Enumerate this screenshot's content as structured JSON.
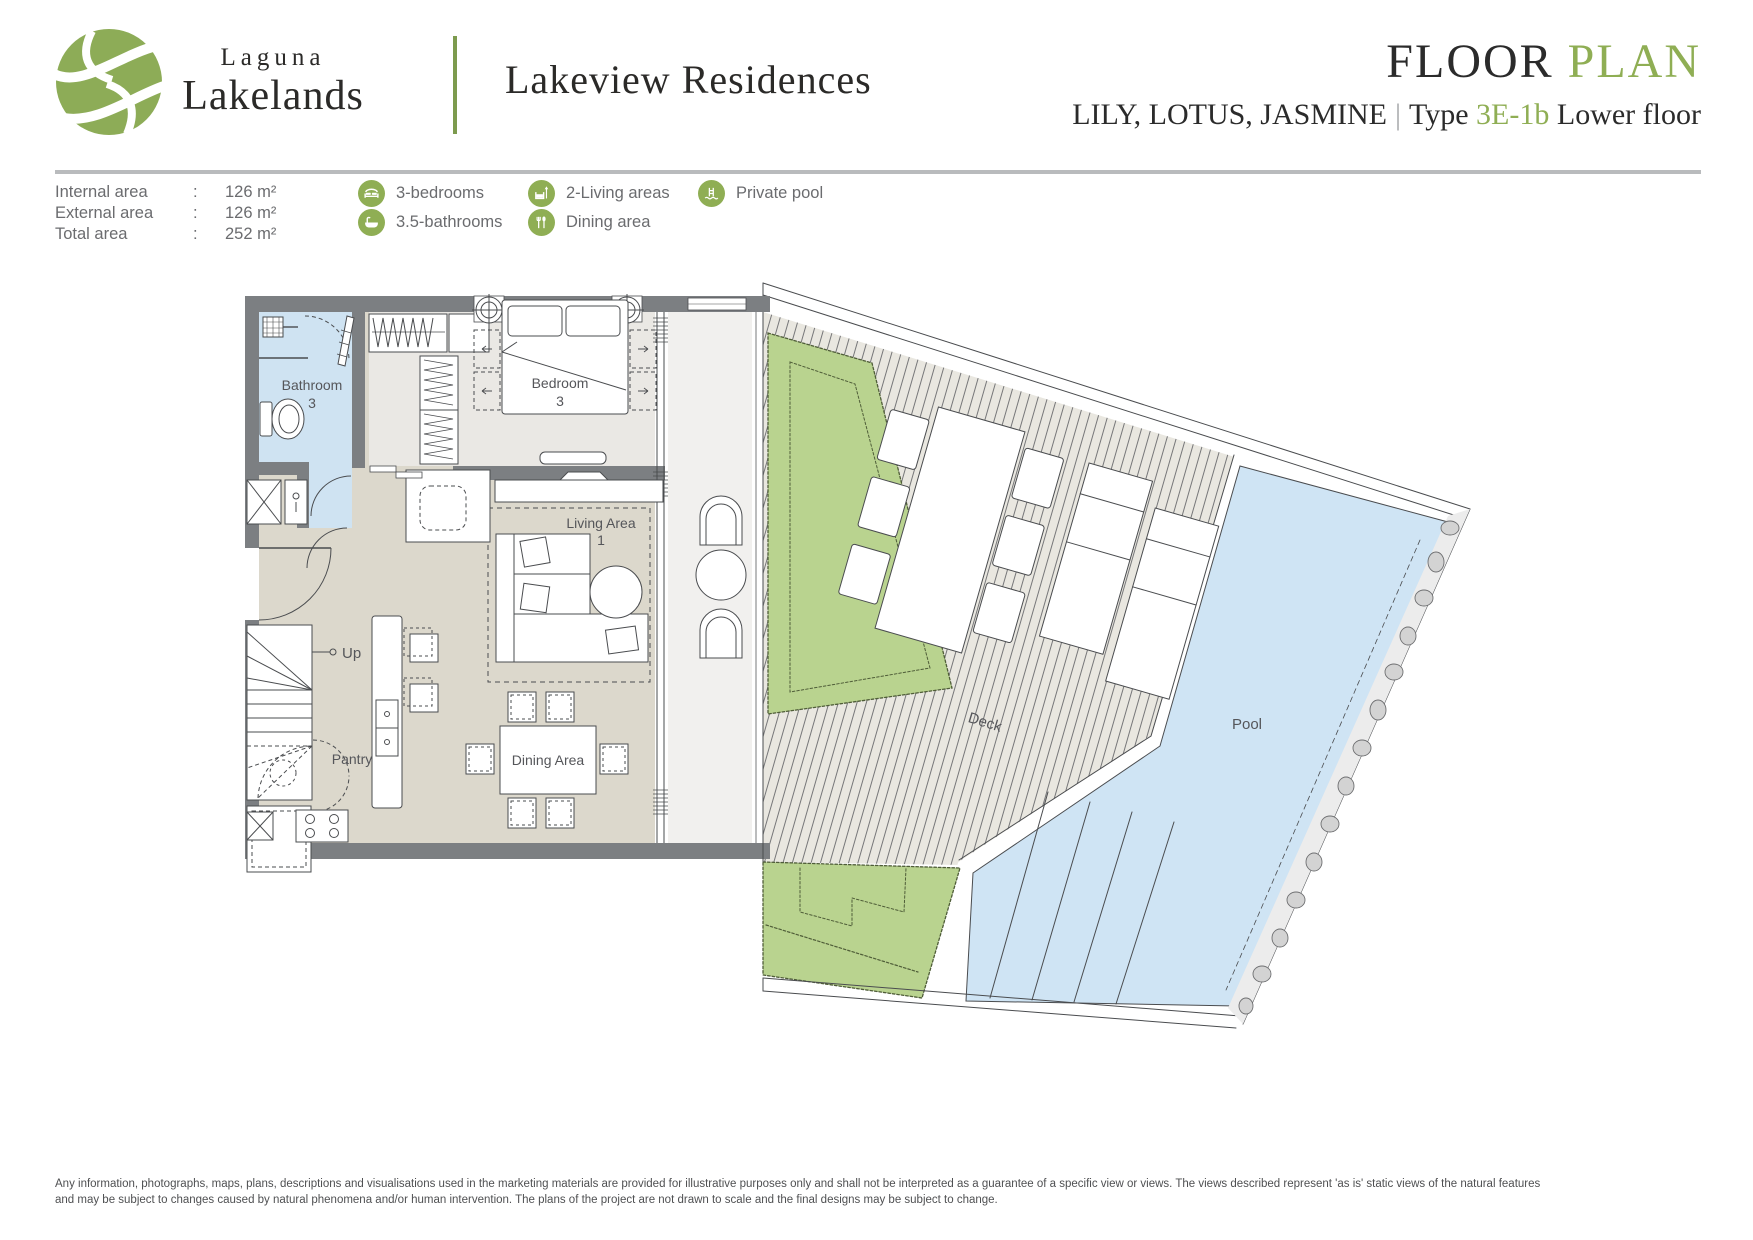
{
  "brand": {
    "name_top": "Laguna",
    "name_bottom": "Lakelands"
  },
  "header": {
    "project": "Lakeview Residences",
    "title_dark": "FLOOR",
    "title_green": "PLAN",
    "subtitle_names": "LILY, LOTUS, JASMINE",
    "subtitle_divider": "|",
    "subtitle_type_label": "Type",
    "subtitle_type_value": "3E-1b",
    "subtitle_floor": "Lower floor"
  },
  "areas": {
    "rows": [
      {
        "label": "Internal area",
        "colon": ":",
        "value": "126 m²"
      },
      {
        "label": "External area",
        "colon": ":",
        "value": "126 m²"
      },
      {
        "label": "Total area",
        "colon": ":",
        "value": "252 m²"
      }
    ]
  },
  "features": [
    {
      "icon": "bed-icon",
      "label": "3-bedrooms"
    },
    {
      "icon": "bathtub-icon",
      "label": "3.5-bathrooms"
    },
    {
      "icon": "armchair-lamp-icon",
      "label": "2-Living areas"
    },
    {
      "icon": "cutlery-icon",
      "label": "Dining area"
    },
    {
      "icon": "pool-ladder-icon",
      "label": "Private pool"
    }
  ],
  "plan": {
    "labels": {
      "bathroom_1": "Bathroom",
      "bathroom_2": "3",
      "bedroom_1": "Bedroom",
      "bedroom_2": "3",
      "living_1": "Living Area",
      "living_2": "1",
      "dining": "Dining Area",
      "pantry": "Pantry",
      "up": "Up",
      "deck": "Deck",
      "pool": "Pool"
    }
  },
  "colors": {
    "accent_green": "#8fae54",
    "wall_gray": "#7c7f82",
    "water_blue": "#cfe4f4",
    "garden_green": "#b9d38f",
    "floor_beige": "#dcd8cc",
    "floor_gray": "#eae8e4"
  },
  "footer": {
    "line1": "Any information, photographs, maps, plans, descriptions and visualisations used in the marketing materials are provided for illustrative purposes only and shall not be interpreted as a guarantee of a specific view or views. The views described represent 'as is' static views of the natural features",
    "line2": "and may be subject to changes caused by natural phenomena and/or human intervention. The plans of the project are not drawn to scale and the final designs may be subject to change."
  }
}
